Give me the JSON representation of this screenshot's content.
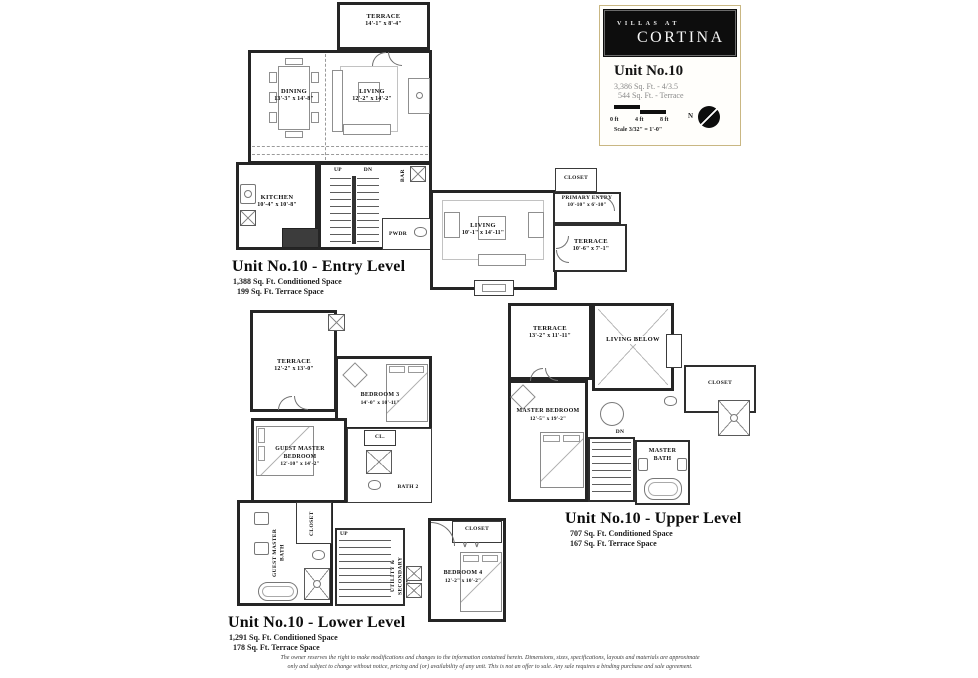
{
  "brand": {
    "top": "VILLAS AT",
    "name": "CORTINA"
  },
  "title_block": {
    "unit": "Unit No.10",
    "stats1": "3,386 Sq. Ft. - 4/3.5",
    "stats2": "  544 Sq. Ft. - Terrace",
    "scale": {
      "t0": "0 ft",
      "t4": "4 ft",
      "t8": "8 ft",
      "north": "N",
      "note": "Scale 3/32\" = 1'-0\""
    }
  },
  "entry": {
    "title": "Unit No.10 - Entry Level",
    "sub1": "1,388 Sq. Ft. Conditioned Space",
    "sub2": "  199 Sq. Ft. Terrace Space",
    "terrace_top": {
      "name": "TERRACE",
      "dims": "14'-1\" x 8'-4\""
    },
    "dining": {
      "name": "DINING",
      "dims": "13'-3\" x 14'-8\""
    },
    "living": {
      "name": "LIVING",
      "dims": "12'-2\" x 14'-2\""
    },
    "kitchen": {
      "name": "KITCHEN",
      "dims": "10'-4\" x 10'-8\""
    },
    "bar": "BAR",
    "up": "UP",
    "dn": "DN",
    "pwdr": "PWDR",
    "living2": {
      "name": "LIVING",
      "dims": "10'-1\" x 14'-11\""
    },
    "closet": "CLOSET",
    "primary_entry": {
      "name": "PRIMARY ENTRY",
      "dims": "10'-10\" x 6'-10\""
    },
    "terrace_side": {
      "name": "TERRACE",
      "dims": "10'-6\" x 7'-1\""
    }
  },
  "lower": {
    "title": "Unit No.10 - Lower Level",
    "sub1": "1,291 Sq. Ft. Conditioned Space",
    "sub2": "  178 Sq. Ft. Terrace Space",
    "terrace": {
      "name": "TERRACE",
      "dims": "12'-2\" x 13'-0\""
    },
    "bedroom3": {
      "name": "BEDROOM 3",
      "dims": "14'-0\" x 10'-11\""
    },
    "guest_master": {
      "name": "GUEST MASTER BEDROOM",
      "dims": "12'-10\" x 14'-2\""
    },
    "cl": "CL.",
    "bath2": "BATH 2",
    "guest_master_bath": "GUEST MASTER BATH",
    "closet_v": "CLOSET",
    "up": "UP",
    "utility": "UTILITY & SECONDARY ENTRY",
    "bedroom4": {
      "name": "BEDROOM 4",
      "dims": "12'-2\" x 10'-2\""
    },
    "closet4": "CLOSET"
  },
  "upper": {
    "title": "Unit No.10 - Upper Level",
    "sub1": "707 Sq. Ft. Conditioned Space",
    "sub2": "167 Sq. Ft. Terrace Space",
    "terrace": {
      "name": "TERRACE",
      "dims": "13'-2\" x 11'-11\""
    },
    "living_below": "LIVING BELOW",
    "closet": "CLOSET",
    "master_bedroom": {
      "name": "MASTER BEDROOM",
      "dims": "12'-5\" x 19'-2\""
    },
    "dn": "DN",
    "master_bath": "MASTER BATH"
  },
  "disclaimer": {
    "line1": "The owner reserves the right to make modifications and changes to the information contained herein. Dimensions, sizes, specifications, layouts and materials are approximate",
    "line2": "only and subject to change without notice, pricing and (or) availability of any unit. This is not an offer to sale. Any sale requires a binding purchase and sale agreement."
  }
}
